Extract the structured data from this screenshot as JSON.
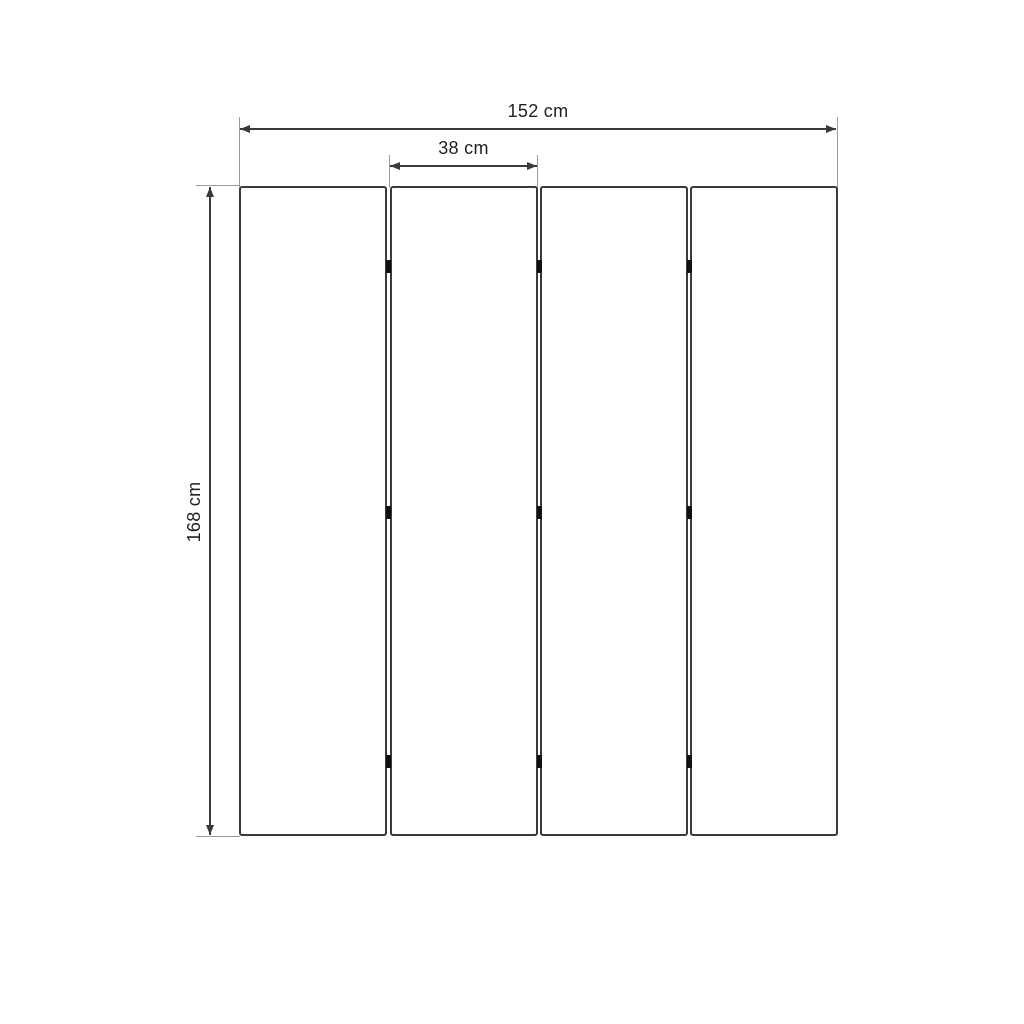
{
  "diagram": {
    "kind": "product-dimension-drawing",
    "panel_count": 4,
    "hinge_rows": 3,
    "labels": {
      "total_width": "152 cm",
      "panel_width": "38 cm",
      "height": "168 cm"
    },
    "colors": {
      "background": "#ffffff",
      "panel_border": "#3a3a3a",
      "dimension_line": "#3a3a3a",
      "extension_line": "#9a9a9a",
      "hinge": "#111111",
      "text": "#1f1f1f"
    }
  }
}
